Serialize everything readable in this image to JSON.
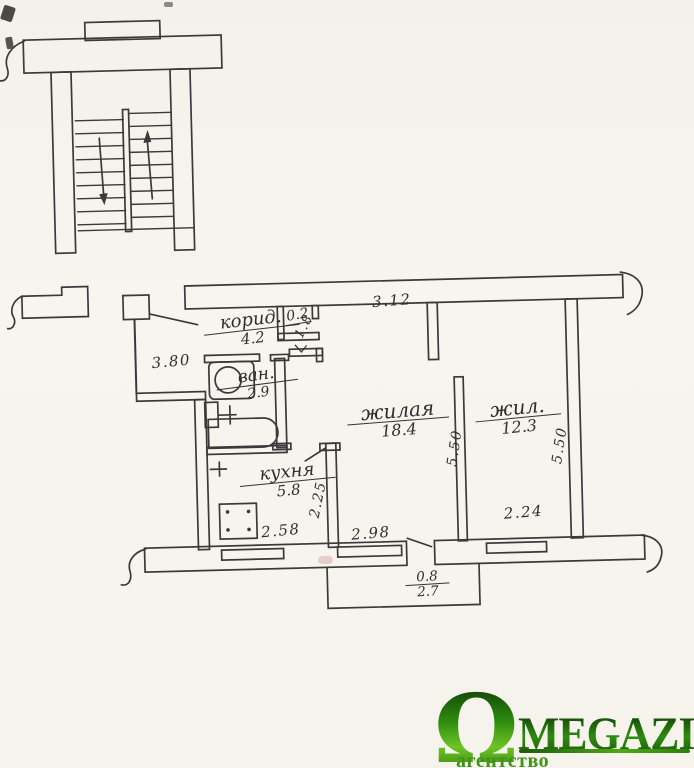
{
  "plan": {
    "rooms": {
      "corridor": {
        "name": "корид.",
        "area": "4.2"
      },
      "closet": {
        "area": "0.2"
      },
      "bathroom": {
        "name": "ван.",
        "area": "2.9"
      },
      "kitchen": {
        "name": "кухня",
        "area": "5.8"
      },
      "living_room": {
        "name": "жилая",
        "area": "18.4"
      },
      "bedroom": {
        "name": "жил.",
        "area": "12.3"
      }
    },
    "dimensions": {
      "corridor_length": "3.80",
      "top_span": "3.12",
      "passage": "1.8",
      "living_room_depth": "5.50",
      "bedroom_depth": "5.50",
      "kitchen_depth": "2.25",
      "kitchen_width": "2.58",
      "living_room_width": "2.98",
      "bedroom_width": "2.24",
      "balcony_depth": "0.8",
      "balcony_width": "2.7"
    }
  },
  "logo": {
    "omega": "Ω",
    "brand": "MEGAZIN",
    "tagline": "агентство недвижимости"
  },
  "colors": {
    "ink": "#3a3a3a",
    "paper": "#f5f3ec",
    "logo_green_dark": "#0d3a07",
    "logo_green": "#2f8c10",
    "logo_green_light": "#6cc424"
  }
}
